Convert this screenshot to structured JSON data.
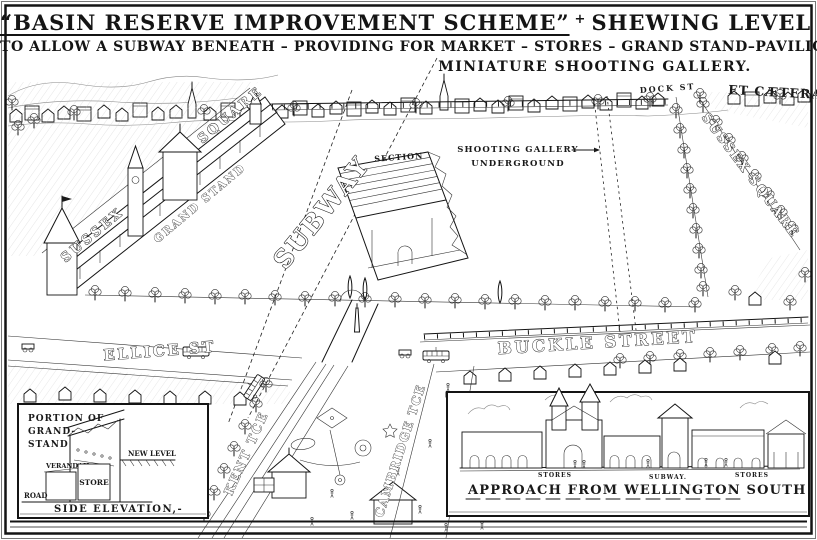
{
  "colors": {
    "ink": "#141414",
    "paper": "#ffffff",
    "hatch": "#bbbbbb"
  },
  "title": {
    "line1": "“BASIN RESERVE IMPROVEMENT SCHEME”",
    "ornament": "+",
    "line1b": "SHEWING LEVEL RAISED",
    "line2": "TO ALLOW A SUBWAY BENEATH – PROVIDING FOR MARKET – STORES – GRAND STAND–PAVILION",
    "line3": "MINIATURE SHOOTING GALLERY.",
    "et_caetera": "ET CÆTERA"
  },
  "map_labels": {
    "sussex_left_line1": "SUSSEX",
    "sussex_left_line2": "SQUARE",
    "grand_stand": "GRAND STAND",
    "dock_st": "DOCK ST",
    "sussex_right": "SUSSEX SQUARE",
    "subway": "SUBWAY",
    "section": "SECTION",
    "shooting_gallery": "SHOOTING GALLERY",
    "underground": "UNDERGROUND",
    "ellice_st": "ELLICE ST",
    "buckle_street": "BUCKLE STREET",
    "kent_tce": "KENT TCE",
    "cambridge_tce": "CAMBRIDGE TCE"
  },
  "inset_side_elevation": {
    "title_line1": "PORTION OF",
    "title_line2": "GRAND-",
    "title_line3": "STAND",
    "verandah": "VERANDAH",
    "store": "STORE",
    "new_level": "NEW LEVEL",
    "road": "ROAD",
    "caption": "SIDE ELEVATION,-"
  },
  "inset_approach": {
    "stores_left": "STORES",
    "subway": "SUBWAY.",
    "stores_right": "STORES",
    "caption": "APPROACH FROM WELLINGTON SOUTH"
  }
}
